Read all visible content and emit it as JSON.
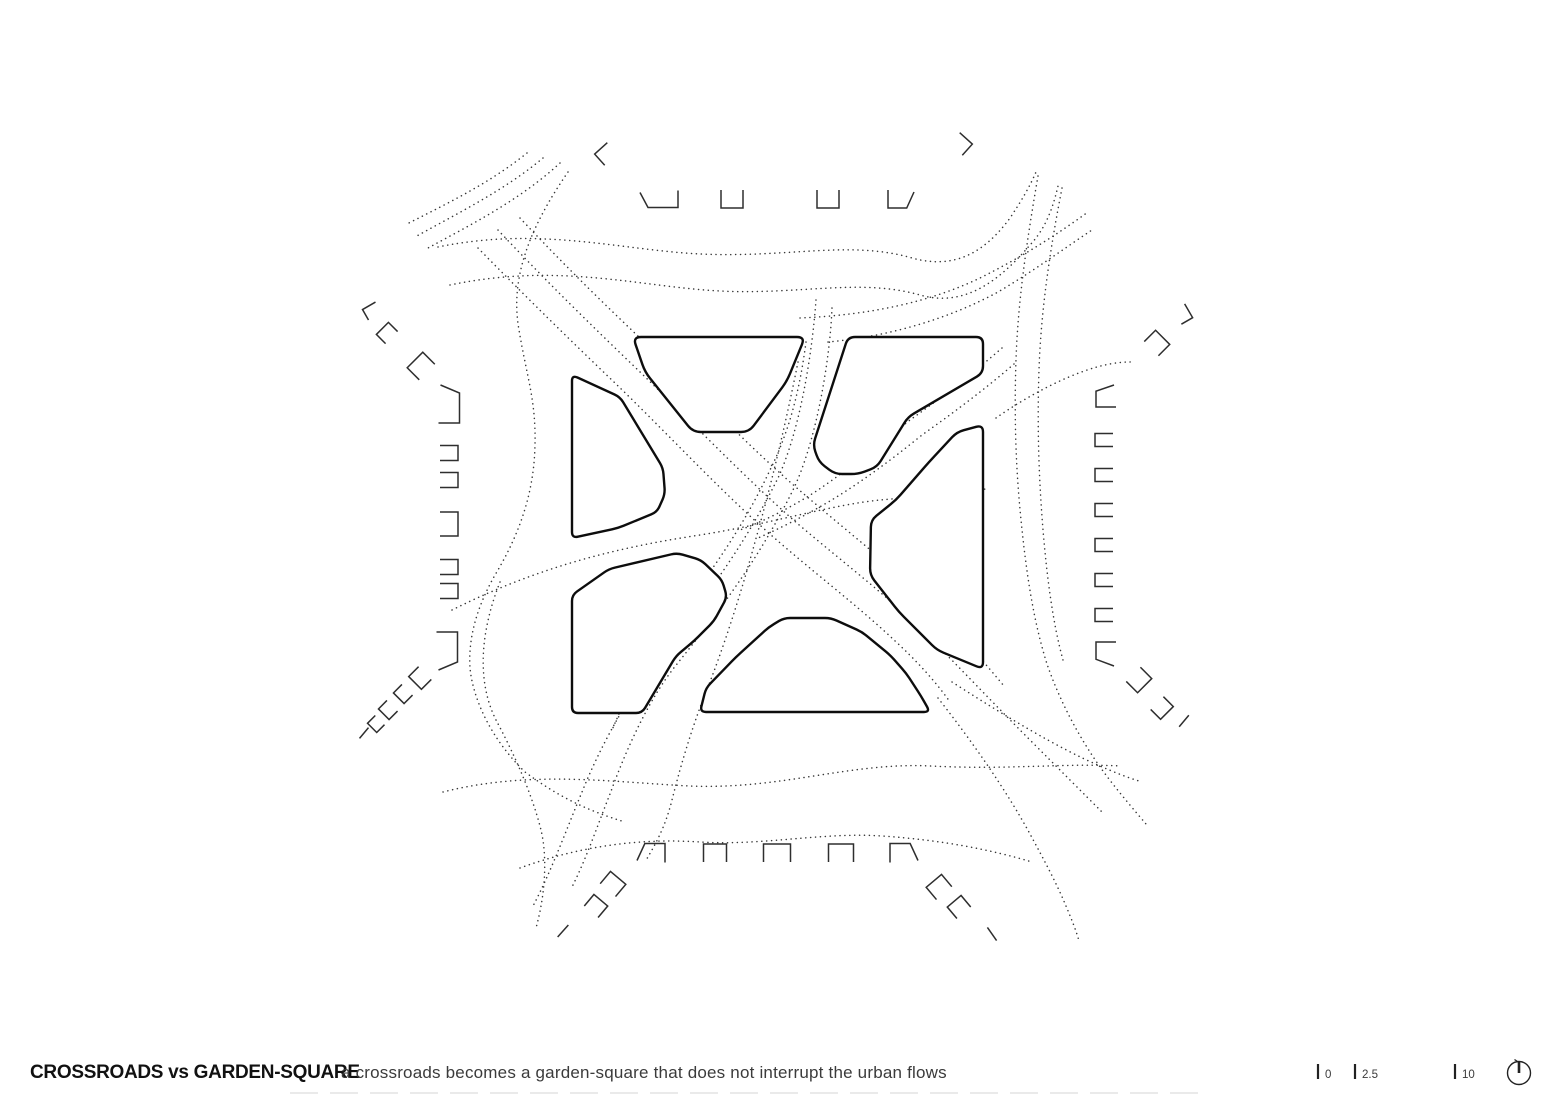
{
  "title": "CROSSROADS vs GARDEN-SQUARE",
  "caption": "a crossroads becomes a garden-square that does not interrupt the urban flows",
  "scale_bar": {
    "ticks": [
      {
        "x": 1318,
        "label": "0"
      },
      {
        "x": 1355,
        "label": "2.5"
      },
      {
        "x": 1455,
        "label": "10"
      }
    ],
    "tick_top": 1064,
    "tick_bottom": 1079,
    "label_dx": 7,
    "label_y": 1078
  },
  "compass": {
    "cx": 1519,
    "cy": 1073,
    "r": 11.5
  },
  "colors": {
    "ink": "#0d0d0d",
    "flow": "#383838",
    "building": "#2e2e2e",
    "marks": "#222222",
    "text_primary": "#111111",
    "text_secondary": "#3b3b3b",
    "faint": "#dedede"
  },
  "drawing": {
    "faint_rule": {
      "x1": 290,
      "x2": 1210,
      "y": 1093
    },
    "islands": [
      {
        "r": 6,
        "points": [
          [
            572,
            375
          ],
          [
            620,
            397
          ],
          [
            663,
            468
          ],
          [
            665,
            494
          ],
          [
            657,
            512
          ],
          [
            618,
            528
          ],
          [
            572,
            538
          ]
        ]
      },
      {
        "r": 8,
        "points": [
          [
            633,
            337
          ],
          [
            805,
            337
          ],
          [
            787,
            381
          ],
          [
            749,
            432
          ],
          [
            693,
            432
          ],
          [
            645,
            372
          ]
        ]
      },
      {
        "r": 7,
        "points": [
          [
            848,
            337
          ],
          [
            983,
            337
          ],
          [
            983,
            373
          ],
          [
            908,
            417
          ],
          [
            877,
            467
          ],
          [
            858,
            474
          ],
          [
            835,
            474
          ],
          [
            819,
            462
          ],
          [
            813,
            445
          ]
        ]
      },
      {
        "r": 7,
        "points": [
          [
            983,
            425
          ],
          [
            957,
            432
          ],
          [
            929,
            462
          ],
          [
            896,
            500
          ],
          [
            871,
            520
          ],
          [
            870,
            575
          ],
          [
            899,
            612
          ],
          [
            937,
            650
          ],
          [
            983,
            669
          ]
        ]
      },
      {
        "r": 6,
        "points": [
          [
            572,
            595
          ],
          [
            609,
            569
          ],
          [
            677,
            553
          ],
          [
            701,
            560
          ],
          [
            722,
            580
          ],
          [
            727,
            597
          ],
          [
            714,
            621
          ],
          [
            694,
            641
          ],
          [
            676,
            656
          ],
          [
            642,
            713
          ],
          [
            572,
            713
          ]
        ]
      },
      {
        "r": 6,
        "points": [
          [
            700,
            712
          ],
          [
            706,
            688
          ],
          [
            736,
            657
          ],
          [
            769,
            627
          ],
          [
            784,
            618
          ],
          [
            831,
            618
          ],
          [
            862,
            632
          ],
          [
            890,
            655
          ],
          [
            906,
            673
          ],
          [
            921,
            696
          ],
          [
            930,
            712
          ]
        ]
      }
    ],
    "flows": [
      "M 438,247 C 540,226 620,250 700,254 C 790,258 850,240 912,258 C 955,270 985,252 1010,218 C 1022,200 1030,186 1036,172",
      "M 450,285 C 560,262 640,287 720,291 C 800,295 860,278 920,295 C 965,308 1000,280 1030,245 C 1044,230 1052,212 1058,186",
      "M 800,318 C 870,315 930,302 980,278 C 1020,258 1055,236 1088,212",
      "M 828,342 C 892,336 950,318 998,292 C 1032,272 1062,250 1092,230",
      "M 560,163 C 520,200 472,224 428,248",
      "M 543,158 C 505,190 458,213 415,237",
      "M 527,153 C 490,183 448,203 405,225",
      "M 568,172 C 528,230 510,280 519,330 C 527,378 536,400 535,445 C 534,498 516,540 495,575 C 478,605 468,636 470,668 C 473,700 492,740 525,772 C 556,795 585,810 625,822",
      "M 500,582 C 481,630 476,680 496,720 C 511,748 531,790 541,830 C 547,855 546,892 536,928",
      "M 452,610 C 540,566 620,547 700,535 C 770,524 830,505 880,500 C 915,497 952,493 986,489",
      "M 996,418 C 1030,394 1076,370 1110,364 C 1120,362 1127,362 1131,362",
      "M 816,300 C 812,355 800,430 778,478 C 742,550 702,602 662,652 C 632,690 602,742 582,792 C 567,828 551,872 533,906",
      "M 832,308 C 830,360 816,444 792,492 C 757,562 717,614 677,664 C 650,697 627,747 610,794 C 598,824 587,857 572,887",
      "M 806,342 C 800,388 790,430 770,470 C 740,534 702,585 664,632 C 643,659 625,700 612,730",
      "M 798,362 C 786,422 772,482 755,542 C 740,597 722,652 706,692 C 694,722 682,760 672,800 C 665,828 655,845 645,862",
      "M 498,230 C 545,280 592,326 638,370 C 690,420 745,478 798,524 C 850,568 895,602 932,640 C 960,668 995,705 1032,742 C 1058,768 1082,792 1102,812",
      "M 520,218 C 565,266 610,310 655,352 C 700,395 752,450 805,495 C 855,538 902,574 938,612 C 962,637 984,662 1004,686",
      "M 478,248 C 525,296 570,340 615,383 C 662,428 712,482 762,527 C 810,570 856,604 894,640 C 916,660 936,682 950,702",
      "M 1002,348 C 972,374 941,398 910,420 C 875,448 845,472 815,492 C 790,508 764,521 740,530",
      "M 1014,364 C 984,390 953,413 922,435 C 890,461 860,483 830,501 C 806,515 781,528 758,538",
      "M 1038,176 C 1027,240 1018,300 1016,360 C 1014,420 1016,470 1021,520 C 1026,570 1033,620 1047,664 C 1060,702 1082,744 1109,779 C 1122,796 1135,811 1146,824",
      "M 1062,188 C 1050,250 1041,310 1039,370 C 1037,430 1039,480 1043,530 C 1047,578 1053,624 1063,660",
      "M 952,682 C 1005,716 1058,748 1100,766 C 1116,773 1129,778 1139,781",
      "M 938,698 C 974,744 1006,790 1030,834 C 1043,858 1056,882 1066,906 C 1071,918 1076,930 1079,941",
      "M 443,792 C 530,770 610,782 690,786 C 780,790 850,762 930,766 C 1010,770 1062,763 1121,766",
      "M 520,868 C 580,846 640,838 700,842 C 762,846 822,832 882,836 C 942,840 992,850 1032,862"
    ],
    "buildings": [
      [
        606,
        154,
        -42,
        17,
        15,
        "v",
        false
      ],
      [
        659,
        199,
        0,
        38,
        17,
        "c",
        false
      ],
      [
        732,
        199,
        0,
        22,
        18,
        "u",
        false
      ],
      [
        828,
        199,
        0,
        22,
        18,
        "u",
        false
      ],
      [
        901,
        199,
        0,
        26,
        18,
        "c",
        true
      ],
      [
        961,
        144,
        42,
        17,
        15,
        "v",
        true
      ],
      [
        1183,
        314,
        60,
        16,
        13,
        "v",
        true
      ],
      [
        1157,
        343,
        225,
        20,
        16,
        "u",
        false
      ],
      [
        1106,
        396,
        90,
        22,
        20,
        "c",
        false
      ],
      [
        1104,
        440,
        90,
        13,
        18,
        "u",
        false
      ],
      [
        1104,
        475,
        90,
        13,
        18,
        "u",
        false
      ],
      [
        1104,
        510,
        90,
        13,
        18,
        "u",
        false
      ],
      [
        1104,
        545,
        90,
        13,
        18,
        "u",
        false
      ],
      [
        1104,
        580,
        90,
        13,
        18,
        "u",
        false
      ],
      [
        1104,
        615,
        90,
        13,
        18,
        "u",
        false
      ],
      [
        1106,
        654,
        90,
        24,
        20,
        "c",
        true
      ],
      [
        1139,
        680,
        315,
        20,
        16,
        "u",
        false
      ],
      [
        1162,
        708,
        315,
        18,
        14,
        "u",
        false
      ],
      [
        1184,
        721,
        -50,
        15,
        1,
        "l",
        false
      ],
      [
        372,
        311,
        -30,
        15,
        12,
        "v",
        false
      ],
      [
        387,
        333,
        135,
        17,
        13,
        "u",
        false
      ],
      [
        421,
        366,
        135,
        22,
        17,
        "u",
        false
      ],
      [
        449,
        404,
        270,
        38,
        21,
        "c",
        true
      ],
      [
        449,
        453,
        270,
        15,
        18,
        "u",
        false
      ],
      [
        449,
        480,
        270,
        15,
        18,
        "u",
        false
      ],
      [
        449,
        524,
        270,
        24,
        18,
        "u",
        false
      ],
      [
        449,
        567,
        270,
        15,
        18,
        "u",
        false
      ],
      [
        449,
        591,
        270,
        15,
        18,
        "u",
        false
      ],
      [
        447,
        651,
        270,
        38,
        21,
        "c",
        false
      ],
      [
        420,
        678,
        45,
        18,
        14,
        "u",
        false
      ],
      [
        403,
        694,
        45,
        15,
        12,
        "u",
        false
      ],
      [
        388,
        710,
        45,
        15,
        12,
        "u",
        false
      ],
      [
        376,
        724,
        45,
        13,
        11,
        "u",
        false
      ],
      [
        364,
        733,
        -50,
        14,
        1,
        "l",
        false
      ],
      [
        651,
        853,
        180,
        28,
        19,
        "c",
        true
      ],
      [
        715,
        853,
        180,
        23,
        18,
        "u",
        false
      ],
      [
        777,
        853,
        180,
        27,
        18,
        "u",
        false
      ],
      [
        841,
        853,
        180,
        25,
        18,
        "u",
        false
      ],
      [
        904,
        853,
        180,
        28,
        19,
        "c",
        false
      ],
      [
        613,
        884,
        220,
        20,
        16,
        "u",
        false
      ],
      [
        596,
        906,
        220,
        18,
        15,
        "u",
        false
      ],
      [
        563,
        931,
        -48,
        16,
        1,
        "l",
        false
      ],
      [
        939,
        887,
        140,
        20,
        16,
        "u",
        false
      ],
      [
        959,
        907,
        140,
        18,
        15,
        "u",
        false
      ],
      [
        992,
        934,
        55,
        16,
        1,
        "l",
        false
      ]
    ]
  }
}
